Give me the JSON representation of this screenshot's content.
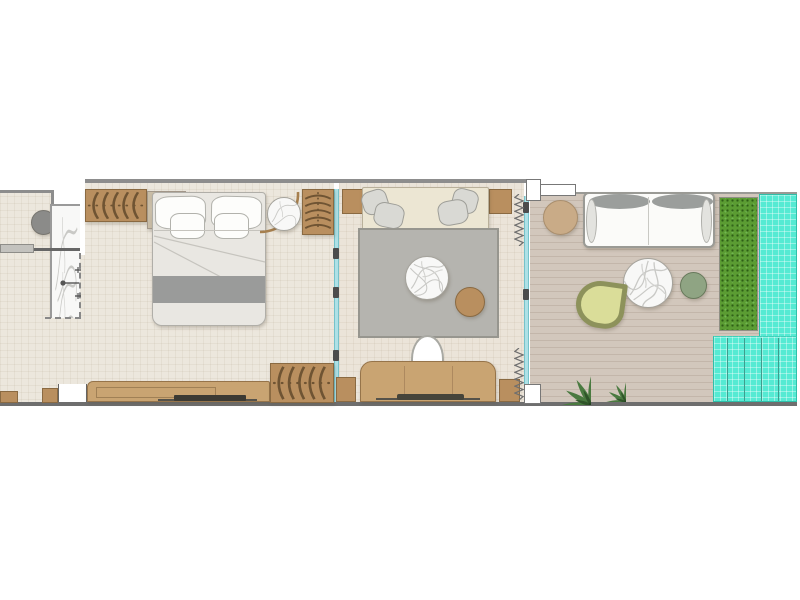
{
  "plan": {
    "kind": "hotel-suite-floor-plan",
    "rooms": [
      {
        "name": "bathroom",
        "furniture": [
          "marble-shower",
          "shower-fixture",
          "glass-enclosure-dashed",
          "vanity-counter",
          "round-stool"
        ]
      },
      {
        "name": "bedroom",
        "furniture": [
          "double-bed",
          "head-pillows",
          "small-pillows",
          "duvet-runner",
          "slatted-wardrobe-left",
          "nightstand",
          "table-lamp",
          "round-marble-side-table",
          "arc-floor-lamp",
          "slatted-wardrobe-right",
          "tv-console",
          "tv",
          "entry-door-opening"
        ]
      },
      {
        "name": "living-room",
        "furniture": [
          "daybed-sofa",
          "throw-pillows",
          "area-rug",
          "round-marble-coffee-table",
          "round-wood-side-table",
          "desk",
          "desk-chair",
          "desk-tray",
          "corner-cabinets",
          "curtains",
          "sliding-glass-partition",
          "sliding-glass-door"
        ]
      },
      {
        "name": "terrace",
        "furniture": [
          "wood-deck",
          "outdoor-sofa",
          "bolster-cushions",
          "round-ottoman",
          "round-marble-table",
          "sage-pouf",
          "curved-lounge-chair",
          "potted-plant-large",
          "potted-plant-small",
          "hedge-planter"
        ]
      },
      {
        "name": "pool",
        "furniture": [
          "lap-pool",
          "pool-steps"
        ]
      }
    ],
    "palette": {
      "floor": "#ece7dd",
      "floor_living": "#ebe4d9",
      "deck": "#d2c7bc",
      "pool": "#55ead3",
      "planter": "#5b9c33",
      "wood": "#b98f5f",
      "wood_light": "#c9a472",
      "glass": "#aee1e6",
      "rug": "#b5b4af",
      "wall": "#8d8d8d",
      "wall_dark": "#6e6e6e",
      "duvet": "#e9e7e2",
      "bed_runner": "#9a9b9a",
      "sofa_beige": "#ece6d3",
      "marble": "#f8f8f7",
      "sage": "#8fa483",
      "lounger": "#dadd99",
      "tan": "#c9ab87",
      "plant": "#4a7a40",
      "bolster": "#9b9e9c",
      "gray_cushion": "#d9d9d4",
      "stool": "#8b8b89",
      "tv": "#3c3a33"
    }
  }
}
